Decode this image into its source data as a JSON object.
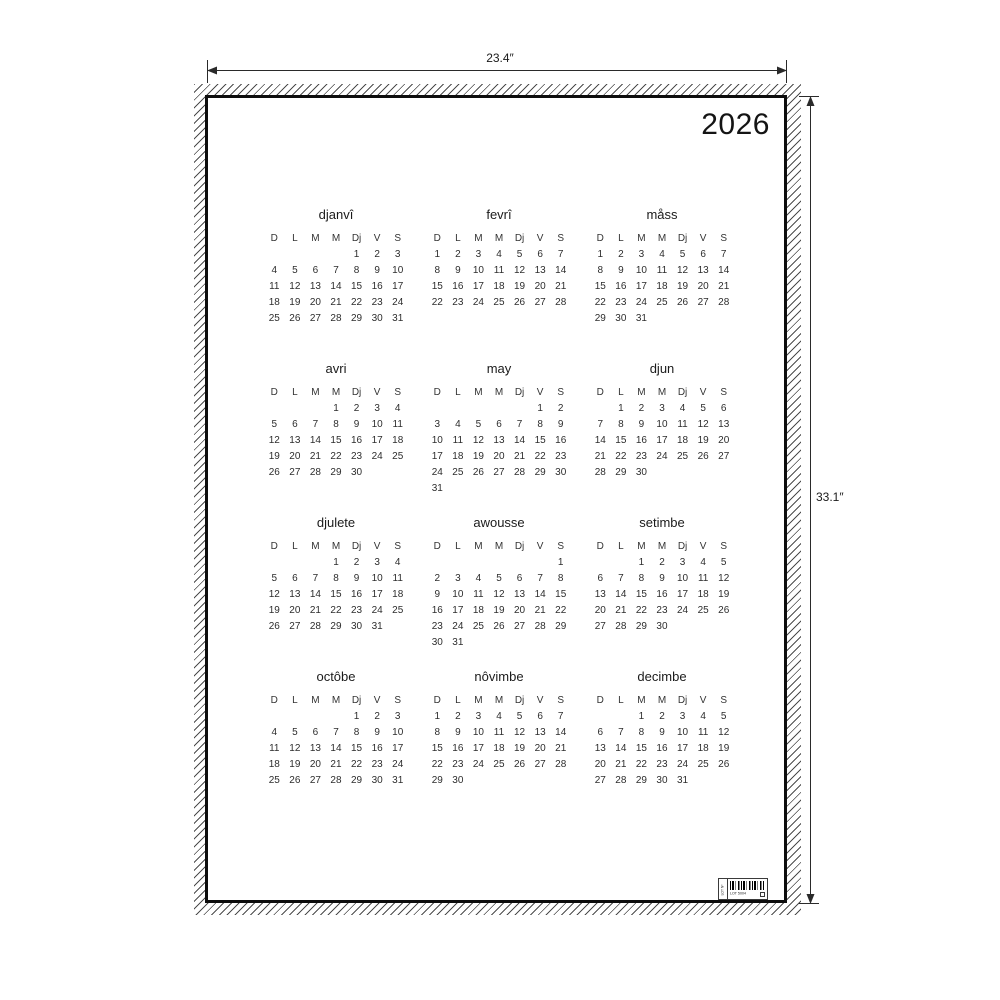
{
  "poster": {
    "year": "2026",
    "day_headers": [
      "D",
      "L",
      "M",
      "M",
      "Dj",
      "V",
      "S"
    ],
    "months": [
      {
        "name": "djanvî",
        "start_dow": 4,
        "days": 31
      },
      {
        "name": "fevrî",
        "start_dow": 0,
        "days": 28
      },
      {
        "name": "måss",
        "start_dow": 0,
        "days": 31
      },
      {
        "name": "avri",
        "start_dow": 3,
        "days": 30
      },
      {
        "name": "may",
        "start_dow": 5,
        "days": 31
      },
      {
        "name": "djun",
        "start_dow": 1,
        "days": 30
      },
      {
        "name": "djulete",
        "start_dow": 3,
        "days": 31
      },
      {
        "name": "awousse",
        "start_dow": 6,
        "days": 31
      },
      {
        "name": "setimbe",
        "start_dow": 2,
        "days": 30
      },
      {
        "name": "octôbe",
        "start_dow": 4,
        "days": 31
      },
      {
        "name": "nôvimbe",
        "start_dow": 0,
        "days": 30
      },
      {
        "name": "decimbe",
        "start_dow": 2,
        "days": 31
      }
    ],
    "barcode_label": {
      "code_text": "LOT 5004",
      "side_text": "LOT Nº"
    }
  },
  "annotations": {
    "width_label": "23.4″",
    "height_label": "33.1″"
  },
  "colors": {
    "ink": "#141414",
    "hatch": "#4d4d4d",
    "poster_border": "#0d0d0d"
  }
}
